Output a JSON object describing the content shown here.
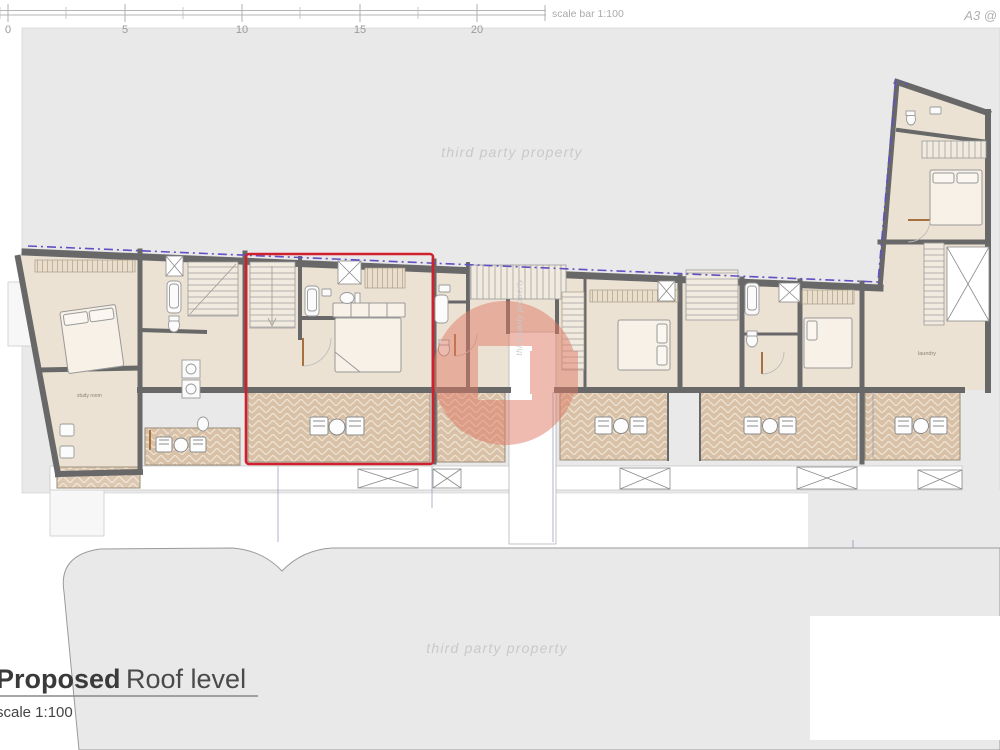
{
  "scale_bar": {
    "label": "scale bar 1:100",
    "ticks": [
      "0",
      "5",
      "10",
      "15",
      "20"
    ]
  },
  "sheet": {
    "size_annotation": "A3 @"
  },
  "watermark": {
    "text": "third party property",
    "logo_letter": "G"
  },
  "plan": {
    "room_labels": {
      "study_room": "study room",
      "laundry": "laundry"
    }
  },
  "title_block": {
    "title_bold": "Proposed",
    "title_regular": "Roof level",
    "scale_note": "scale 1:100"
  },
  "highlight": {
    "description": "selected unit outline",
    "color": "#d0202e"
  },
  "colors": {
    "background_gray": "#e9e9e9",
    "wall": "#686868",
    "room_fill": "#ece2d4",
    "terrace_fill": "#d8c1a7",
    "boundary_dash": "#5f51c4",
    "watermark_pink": "#e07a66",
    "watermark_text": "#c9c9c9"
  }
}
